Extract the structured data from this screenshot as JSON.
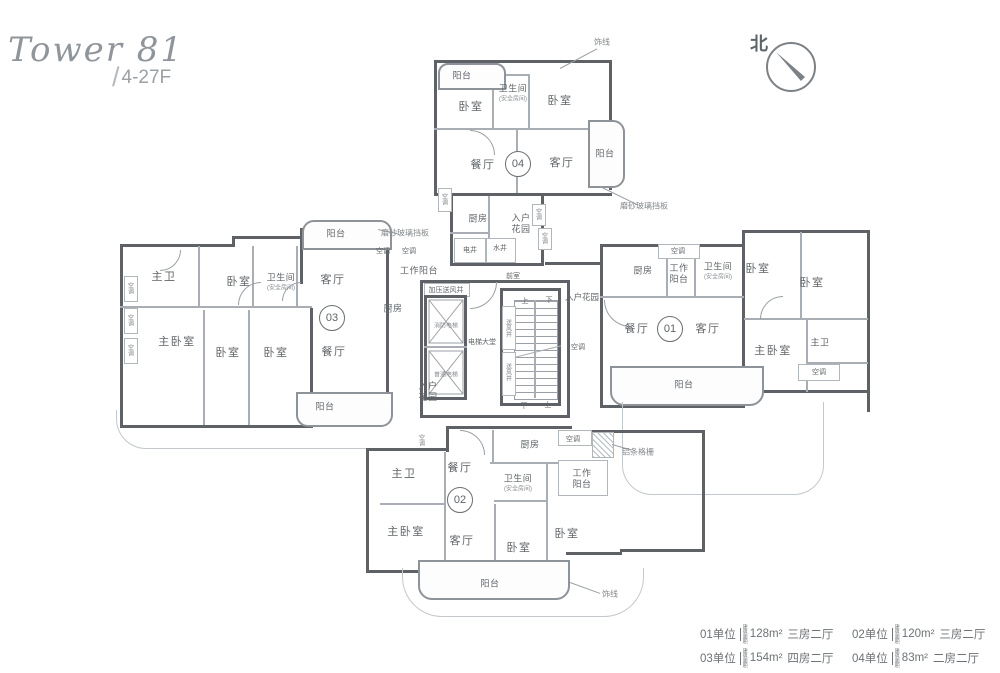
{
  "title": {
    "name": "Tower 81",
    "slash": "/",
    "floors": "4-27F"
  },
  "north": {
    "label": "北"
  },
  "legend": {
    "area_note": "建筑面积",
    "items": [
      {
        "unit": "01单位",
        "area": "128m²",
        "layout": "三房二厅"
      },
      {
        "unit": "02单位",
        "area": "120m²",
        "layout": "三房二厅"
      },
      {
        "unit": "03单位",
        "area": "154m²",
        "layout": "四房二厅"
      },
      {
        "unit": "04单位",
        "area": "83m²",
        "layout": "二房二厅"
      }
    ]
  },
  "units": [
    {
      "id": "01",
      "n": "unit-01-badge",
      "x": 670,
      "y": 329
    },
    {
      "id": "02",
      "n": "unit-02-badge",
      "x": 460,
      "y": 500
    },
    {
      "id": "03",
      "n": "unit-03-badge",
      "x": 332,
      "y": 318
    },
    {
      "id": "04",
      "n": "unit-04-badge",
      "x": 518,
      "y": 164
    }
  ],
  "rooms": [
    {
      "label": "阳台",
      "n": "balcony-label",
      "x": 462,
      "y": 75,
      "cls": "rm9"
    },
    {
      "label": "卫生间",
      "n": "bathroom-label",
      "x": 513,
      "y": 88,
      "cls": "rm9"
    },
    {
      "label": "(安全房间)",
      "n": "safe-room-note",
      "x": 513,
      "y": 98,
      "cls": "micro"
    },
    {
      "label": "卧室",
      "n": "bedroom-label",
      "x": 471,
      "y": 106,
      "cls": ""
    },
    {
      "label": "卧室",
      "n": "bedroom-label",
      "x": 560,
      "y": 100,
      "cls": ""
    },
    {
      "label": "餐厅",
      "n": "dining-room-label",
      "x": 483,
      "y": 164,
      "cls": ""
    },
    {
      "label": "客厅",
      "n": "living-room-label",
      "x": 562,
      "y": 162,
      "cls": ""
    },
    {
      "label": "阳台",
      "n": "balcony-label",
      "x": 605,
      "y": 153,
      "cls": "rm9"
    },
    {
      "label": "饰线",
      "n": "trim-line-note",
      "x": 602,
      "y": 42,
      "cls": "annot"
    },
    {
      "label": "磨砂玻璃挡板",
      "n": "frosted-glass-panel-note",
      "x": 644,
      "y": 206,
      "cls": "annot"
    },
    {
      "label": "厨房",
      "n": "kitchen-label",
      "x": 478,
      "y": 218,
      "cls": "rm9"
    },
    {
      "label": "入户花园",
      "n": "entry-garden-label",
      "x": 521,
      "y": 224,
      "cls": "wrap24"
    },
    {
      "label": "电井",
      "n": "electric-shaft-label",
      "x": 470,
      "y": 250,
      "cls": "tiny"
    },
    {
      "label": "水井",
      "n": "water-shaft-label",
      "x": 500,
      "y": 248,
      "cls": "tiny"
    },
    {
      "label": "空调",
      "n": "ac-unit-label",
      "x": 444,
      "y": 199,
      "cls": "vtext"
    },
    {
      "label": "空调",
      "n": "ac-unit-label",
      "x": 538,
      "y": 214,
      "cls": "vtext"
    },
    {
      "label": "空调",
      "n": "ac-unit-label",
      "x": 544,
      "y": 238,
      "cls": "vtext"
    },
    {
      "label": "磨砂玻璃挡板",
      "n": "frosted-glass-panel-note",
      "x": 405,
      "y": 233,
      "cls": "annot"
    },
    {
      "label": "空调",
      "n": "ac-unit-label",
      "x": 383,
      "y": 251,
      "cls": "tiny"
    },
    {
      "label": "空调",
      "n": "ac-unit-label",
      "x": 409,
      "y": 251,
      "cls": "tiny"
    },
    {
      "label": "工作阳台",
      "n": "utility-balcony-label",
      "x": 419,
      "y": 270,
      "cls": "rm9"
    },
    {
      "label": "加压送风井",
      "n": "pressurized-air-shaft-label",
      "x": 446,
      "y": 290,
      "cls": "tiny"
    },
    {
      "label": "厨房",
      "n": "kitchen-label",
      "x": 393,
      "y": 308,
      "cls": "rm9"
    },
    {
      "label": "前室",
      "n": "vestibule-label",
      "x": 513,
      "y": 276,
      "cls": "tiny"
    },
    {
      "label": "入户花园",
      "n": "entry-garden-label",
      "x": 582,
      "y": 297,
      "cls": "small"
    },
    {
      "label": "空调",
      "n": "ac-unit-label",
      "x": 578,
      "y": 347,
      "cls": "tiny"
    },
    {
      "label": "电梯大堂",
      "n": "elevator-lobby-label",
      "x": 482,
      "y": 342,
      "cls": "tiny"
    },
    {
      "label": "消防电梯",
      "n": "fire-elevator-label",
      "x": 446,
      "y": 325,
      "cls": "micro"
    },
    {
      "label": "普通电梯",
      "n": "passenger-elevator-label",
      "x": 446,
      "y": 374,
      "cls": "micro"
    },
    {
      "label": "送风井",
      "n": "air-shaft-label",
      "x": 508,
      "y": 328,
      "cls": "vtext"
    },
    {
      "label": "送风井",
      "n": "air-shaft-label",
      "x": 508,
      "y": 372,
      "cls": "vtext"
    },
    {
      "label": "上",
      "n": "stairs-up-label",
      "x": 525,
      "y": 301,
      "cls": "tiny"
    },
    {
      "label": "下",
      "n": "stairs-down-label",
      "x": 549,
      "y": 300,
      "cls": "tiny"
    },
    {
      "label": "下",
      "n": "stairs-down-label",
      "x": 524,
      "y": 406,
      "cls": "tiny"
    },
    {
      "label": "上",
      "n": "stairs-up-label",
      "x": 548,
      "y": 405,
      "cls": "tiny"
    },
    {
      "label": "阳台",
      "n": "balcony-label",
      "x": 336,
      "y": 233,
      "cls": "rm9"
    },
    {
      "label": "主卫",
      "n": "master-bath-label",
      "x": 164,
      "y": 276,
      "cls": ""
    },
    {
      "label": "卧室",
      "n": "bedroom-label",
      "x": 239,
      "y": 281,
      "cls": ""
    },
    {
      "label": "卫生间",
      "n": "bathroom-label",
      "x": 281,
      "y": 277,
      "cls": "rm9"
    },
    {
      "label": "(安全房间)",
      "n": "safe-room-note",
      "x": 281,
      "y": 287,
      "cls": "micro"
    },
    {
      "label": "客厅",
      "n": "living-room-label",
      "x": 333,
      "y": 279,
      "cls": ""
    },
    {
      "label": "餐厅",
      "n": "dining-room-label",
      "x": 334,
      "y": 351,
      "cls": ""
    },
    {
      "label": "主卧室",
      "n": "master-bedroom-label",
      "x": 177,
      "y": 341,
      "cls": ""
    },
    {
      "label": "卧室",
      "n": "bedroom-label",
      "x": 228,
      "y": 352,
      "cls": ""
    },
    {
      "label": "卧室",
      "n": "bedroom-label",
      "x": 276,
      "y": 352,
      "cls": ""
    },
    {
      "label": "阳台",
      "n": "balcony-label",
      "x": 325,
      "y": 406,
      "cls": "rm9"
    },
    {
      "label": "空调",
      "n": "ac-unit-label",
      "x": 130,
      "y": 288,
      "cls": "vtext"
    },
    {
      "label": "空调",
      "n": "ac-unit-label",
      "x": 130,
      "y": 320,
      "cls": "vtext"
    },
    {
      "label": "空调",
      "n": "ac-unit-label",
      "x": 130,
      "y": 350,
      "cls": "vtext"
    },
    {
      "label": "入户花园",
      "n": "entry-garden-label",
      "x": 428,
      "y": 392,
      "cls": "wrap24"
    },
    {
      "label": "空调",
      "n": "ac-unit-label",
      "x": 678,
      "y": 251,
      "cls": "tiny"
    },
    {
      "label": "厨房",
      "n": "kitchen-label",
      "x": 643,
      "y": 270,
      "cls": "rm9"
    },
    {
      "label": "工作阳台",
      "n": "utility-balcony-label",
      "x": 679,
      "y": 274,
      "cls": "wrap24"
    },
    {
      "label": "卫生间",
      "n": "bathroom-label",
      "x": 718,
      "y": 266,
      "cls": "rm9"
    },
    {
      "label": "(安全房间)",
      "n": "safe-room-note",
      "x": 718,
      "y": 276,
      "cls": "micro"
    },
    {
      "label": "卧室",
      "n": "bedroom-label",
      "x": 758,
      "y": 268,
      "cls": ""
    },
    {
      "label": "卧室",
      "n": "bedroom-label",
      "x": 812,
      "y": 282,
      "cls": ""
    },
    {
      "label": "餐厅",
      "n": "dining-room-label",
      "x": 637,
      "y": 328,
      "cls": ""
    },
    {
      "label": "客厅",
      "n": "living-room-label",
      "x": 708,
      "y": 328,
      "cls": ""
    },
    {
      "label": "主卧室",
      "n": "master-bedroom-label",
      "x": 773,
      "y": 350,
      "cls": ""
    },
    {
      "label": "主卫",
      "n": "master-bath-label",
      "x": 820,
      "y": 342,
      "cls": "rm9"
    },
    {
      "label": "空调",
      "n": "ac-unit-label",
      "x": 819,
      "y": 372,
      "cls": "tiny"
    },
    {
      "label": "阳台",
      "n": "balcony-label",
      "x": 684,
      "y": 384,
      "cls": "rm9"
    },
    {
      "label": "餐厅",
      "n": "dining-room-label",
      "x": 460,
      "y": 467,
      "cls": ""
    },
    {
      "label": "厨房",
      "n": "kitchen-label",
      "x": 530,
      "y": 444,
      "cls": "rm9"
    },
    {
      "label": "空调",
      "n": "ac-unit-label",
      "x": 573,
      "y": 439,
      "cls": "tiny"
    },
    {
      "label": "空调",
      "n": "ac-unit-label",
      "x": 421,
      "y": 440,
      "cls": "vtext"
    },
    {
      "label": "主卫",
      "n": "master-bath-label",
      "x": 404,
      "y": 473,
      "cls": ""
    },
    {
      "label": "卫生间",
      "n": "bathroom-label",
      "x": 518,
      "y": 478,
      "cls": "rm9"
    },
    {
      "label": "(安全房间)",
      "n": "safe-room-note",
      "x": 518,
      "y": 488,
      "cls": "micro"
    },
    {
      "label": "工作阳台",
      "n": "utility-balcony-label",
      "x": 582,
      "y": 479,
      "cls": "wrap24"
    },
    {
      "label": "主卧室",
      "n": "master-bedroom-label",
      "x": 406,
      "y": 531,
      "cls": ""
    },
    {
      "label": "客厅",
      "n": "living-room-label",
      "x": 462,
      "y": 540,
      "cls": ""
    },
    {
      "label": "卧室",
      "n": "bedroom-label",
      "x": 519,
      "y": 547,
      "cls": ""
    },
    {
      "label": "卧室",
      "n": "bedroom-label",
      "x": 567,
      "y": 533,
      "cls": ""
    },
    {
      "label": "阳台",
      "n": "balcony-label",
      "x": 490,
      "y": 583,
      "cls": "rm9"
    },
    {
      "label": "铝条格栅",
      "n": "aluminum-grille-note",
      "x": 638,
      "y": 452,
      "cls": "annot"
    },
    {
      "label": "饰线",
      "n": "trim-line-note",
      "x": 610,
      "y": 594,
      "cls": "annot"
    }
  ]
}
